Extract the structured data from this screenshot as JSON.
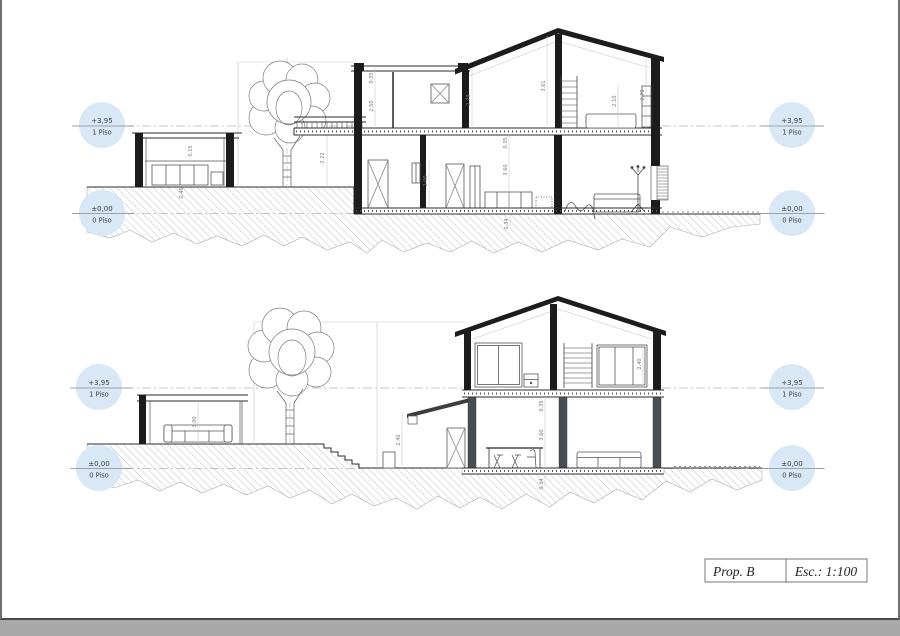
{
  "sheet": {
    "background": "#ffffff",
    "surround": "#a9a9a9",
    "border_color": "#707070"
  },
  "colors": {
    "marker_fill": "#d9e8f6",
    "ink": "#1c1c1c",
    "hatch": "#b6bdc4",
    "datum_dash": "#b5b5b5"
  },
  "levels": {
    "upper": {
      "value": "+3,95",
      "label": "1 Piso"
    },
    "ground": {
      "value": "±0,00",
      "label": "0 Piso"
    }
  },
  "title_block": {
    "proposal": "Prop. B",
    "scale": "Esc.: 1:100"
  },
  "dims": {
    "top": {
      "outb_roof": "0.15",
      "outb_base": "0.46",
      "entry_h": "2.22",
      "parapet": "0.35",
      "upper_left_h": "2.50",
      "upper_mid_h": "2.79",
      "ridge_h": "3.61",
      "bed_zone_h": "2.10",
      "right_eave_h": "2.70",
      "gf_slab": "0.35",
      "door_h": "2.00",
      "gf_h": "3.60",
      "under_slab": "0.34"
    },
    "bottom": {
      "pavilion_h": "3.00",
      "canopy_h": "2.40",
      "window_h": "2.40",
      "gf_slab": "0.35",
      "gf_h": "3.60",
      "under_slab": "0.34"
    }
  }
}
